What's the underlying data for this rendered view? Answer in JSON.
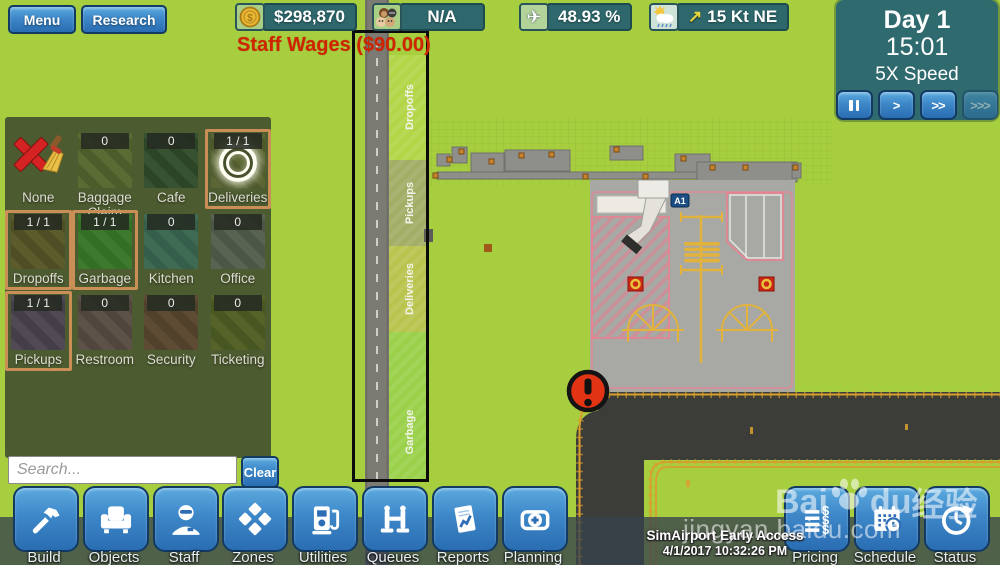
{
  "colors": {
    "background_green": "#a6ce3e",
    "panel_olive": "#495630",
    "ui_teal": "#2e686c",
    "accent_blue": "#3d87c8",
    "selection_orange": "#c98f57",
    "alert_red": "#e23414",
    "wages_red": "#cf2400",
    "taxiway_dark": "#3c3c39",
    "taxiway_yellow": "#d89f2e",
    "apron_gray": "#a8a8a4"
  },
  "icons": {
    "dollar": "$"
  },
  "top_bar": {
    "menu_label": "Menu",
    "research_label": "Research",
    "money": "$298,870",
    "passengers": "N/A",
    "flights_pct": "48.93 %",
    "wind": "15 Kt NE",
    "wind_arrow": "↗",
    "plane_glyph": "✈",
    "wages_note": "Staff Wages ($90.00)"
  },
  "clock": {
    "day": "Day 1",
    "time": "15:01",
    "speed": "5X Speed",
    "speeds": [
      ">",
      ">>",
      ">>>"
    ]
  },
  "zones_panel": {
    "search_placeholder": "Search...",
    "clear_label": "Clear",
    "tiles": [
      {
        "label": "None",
        "count": "",
        "selected": false,
        "c1": "",
        "c2": ""
      },
      {
        "label": "BaggageClaim",
        "count": "0",
        "selected": false,
        "c1": "#5a6b33",
        "c2": "#4c5c2a"
      },
      {
        "label": "Cafe",
        "count": "0",
        "selected": false,
        "c1": "#375230",
        "c2": "#2d4527"
      },
      {
        "label": "Deliveries",
        "count": "1 / 1",
        "selected": true,
        "c1": "#5a6533",
        "c2": "#4c5729"
      },
      {
        "label": "Dropoffs",
        "count": "1 / 1",
        "selected": true,
        "c1": "#5c5b2c",
        "c2": "#4e4d24"
      },
      {
        "label": "Garbage",
        "count": "1 / 1",
        "selected": true,
        "c1": "#3e7a2e",
        "c2": "#337026"
      },
      {
        "label": "Kitchen",
        "count": "0",
        "selected": false,
        "c1": "#3f6b55",
        "c2": "#355f4b"
      },
      {
        "label": "Office",
        "count": "0",
        "selected": false,
        "c1": "#596351",
        "c2": "#4c5646"
      },
      {
        "label": "Pickups",
        "count": "1 / 1",
        "selected": true,
        "c1": "#514a55",
        "c2": "#443e48"
      },
      {
        "label": "Restroom",
        "count": "0",
        "selected": false,
        "c1": "#5d5248",
        "c2": "#50463d"
      },
      {
        "label": "Security",
        "count": "0",
        "selected": false,
        "c1": "#5d4b33",
        "c2": "#51402b"
      },
      {
        "label": "Ticketing",
        "count": "0",
        "selected": false,
        "c1": "#556329",
        "c2": "#485622"
      }
    ]
  },
  "toolbar": {
    "left": [
      {
        "label": "Build"
      },
      {
        "label": "Objects"
      },
      {
        "label": "Staff"
      },
      {
        "label": "Zones"
      },
      {
        "label": "Utilities"
      },
      {
        "label": "Queues"
      },
      {
        "label": "Reports"
      },
      {
        "label": "Planning"
      }
    ],
    "right": [
      {
        "label": "Pricing"
      },
      {
        "label": "Schedule"
      },
      {
        "label": "Status"
      }
    ]
  },
  "map": {
    "gate_label": "A1",
    "strips": [
      {
        "label": "Dropoffs"
      },
      {
        "label": "Pickups"
      },
      {
        "label": "Deliveries"
      },
      {
        "label": "Garbage"
      }
    ]
  },
  "footer": {
    "line1": "SimAirport Early Access",
    "line2": "4/1/2017 10:32:26 PM"
  },
  "watermark": {
    "brand_pre": "Bai",
    "brand_post": "du",
    "brand_cn": "经验",
    "url": "jingyan.baidu.com"
  }
}
